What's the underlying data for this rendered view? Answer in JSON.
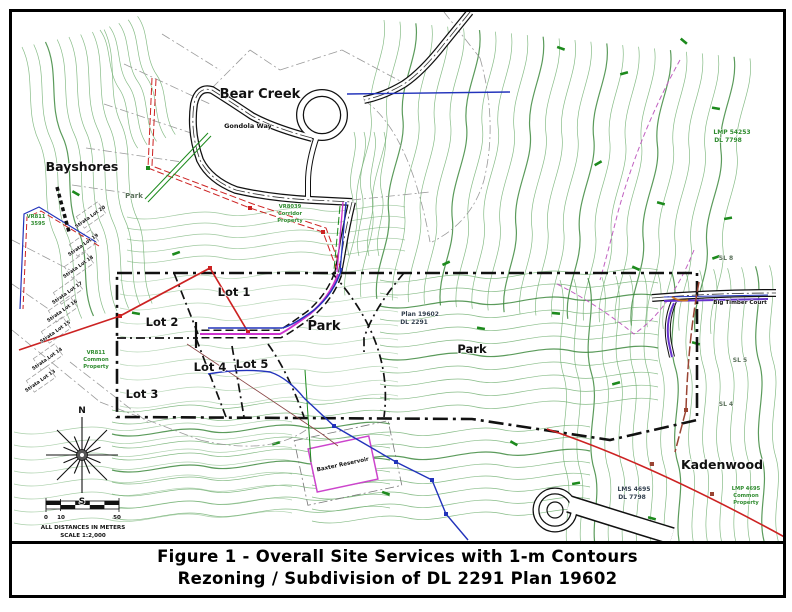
{
  "figure": {
    "title_line1": "Figure 1 - Overall Site Services with 1-m Contours",
    "title_line2": "Rezoning / Subdivision of DL 2291 Plan 19602"
  },
  "map": {
    "labels": {
      "bear_creek": "Bear Creek",
      "gondola_way": "Gondola Way",
      "bayshores": "Bayshores",
      "park_nw": "Park",
      "park_center": "Park",
      "park_east": "Park",
      "lot1": "Lot 1",
      "lot2": "Lot 2",
      "lot3": "Lot 3",
      "lot4": "Lot 4",
      "lot5": "Lot 5",
      "plan_line1": "Plan 19602",
      "plan_line2": "DL 2291",
      "vr811_plan_line1": "VR811",
      "vr811_plan_line2": "3595",
      "vr811_common_line1": "VR811",
      "vr811_common_line2": "Common",
      "vr811_common_line3": "Property",
      "corridor_line1": "VR8039",
      "corridor_line2": "Corridor",
      "corridor_line3": "Property",
      "lmp54253_line1": "LMP 54253",
      "lmp54253_line2": "DL 7798",
      "lms4695_line1": "LMS 4695",
      "lms4695_line2": "DL 7798",
      "lmp_common_line1": "LMP 4695",
      "lmp_common_line2": "Common",
      "lmp_common_line3": "Property",
      "sl8": "SL 8",
      "sl5": "SL 5",
      "sl4": "SL 4",
      "big_timber_court": "Big Timber Court",
      "kadenwood": "Kadenwood",
      "baxter_reservoir": "Baxter Reservoir",
      "strata_lots": [
        "Strata Lot 20",
        "Strata Lot 19",
        "Strata Lot 18",
        "Strata Lot 17",
        "Strata Lot 16",
        "Strata Lot 15",
        "Strata Lot 14",
        "Strata Lot 13"
      ]
    },
    "compass": {
      "north": "N",
      "south": "S"
    },
    "scale_bar": {
      "tick_0": "0",
      "tick_10": "10",
      "tick_50": "50",
      "note_line1": "ALL DISTANCES IN METERS",
      "note_line2": "SCALE 1:2,000"
    },
    "legend_colors": {
      "contour_green": "#72b072",
      "index_contour_green": "#3e8a3e",
      "vegetation_green": "#1d8a1d",
      "watermain_blue": "#2233bb",
      "sewer_magenta": "#cc33cc",
      "power_red": "#cc2222",
      "road_brown": "#994433",
      "utility_purple": "#6633cc",
      "boundary_black": "#111111",
      "cadastral_gray": "#9a9a9a"
    }
  }
}
